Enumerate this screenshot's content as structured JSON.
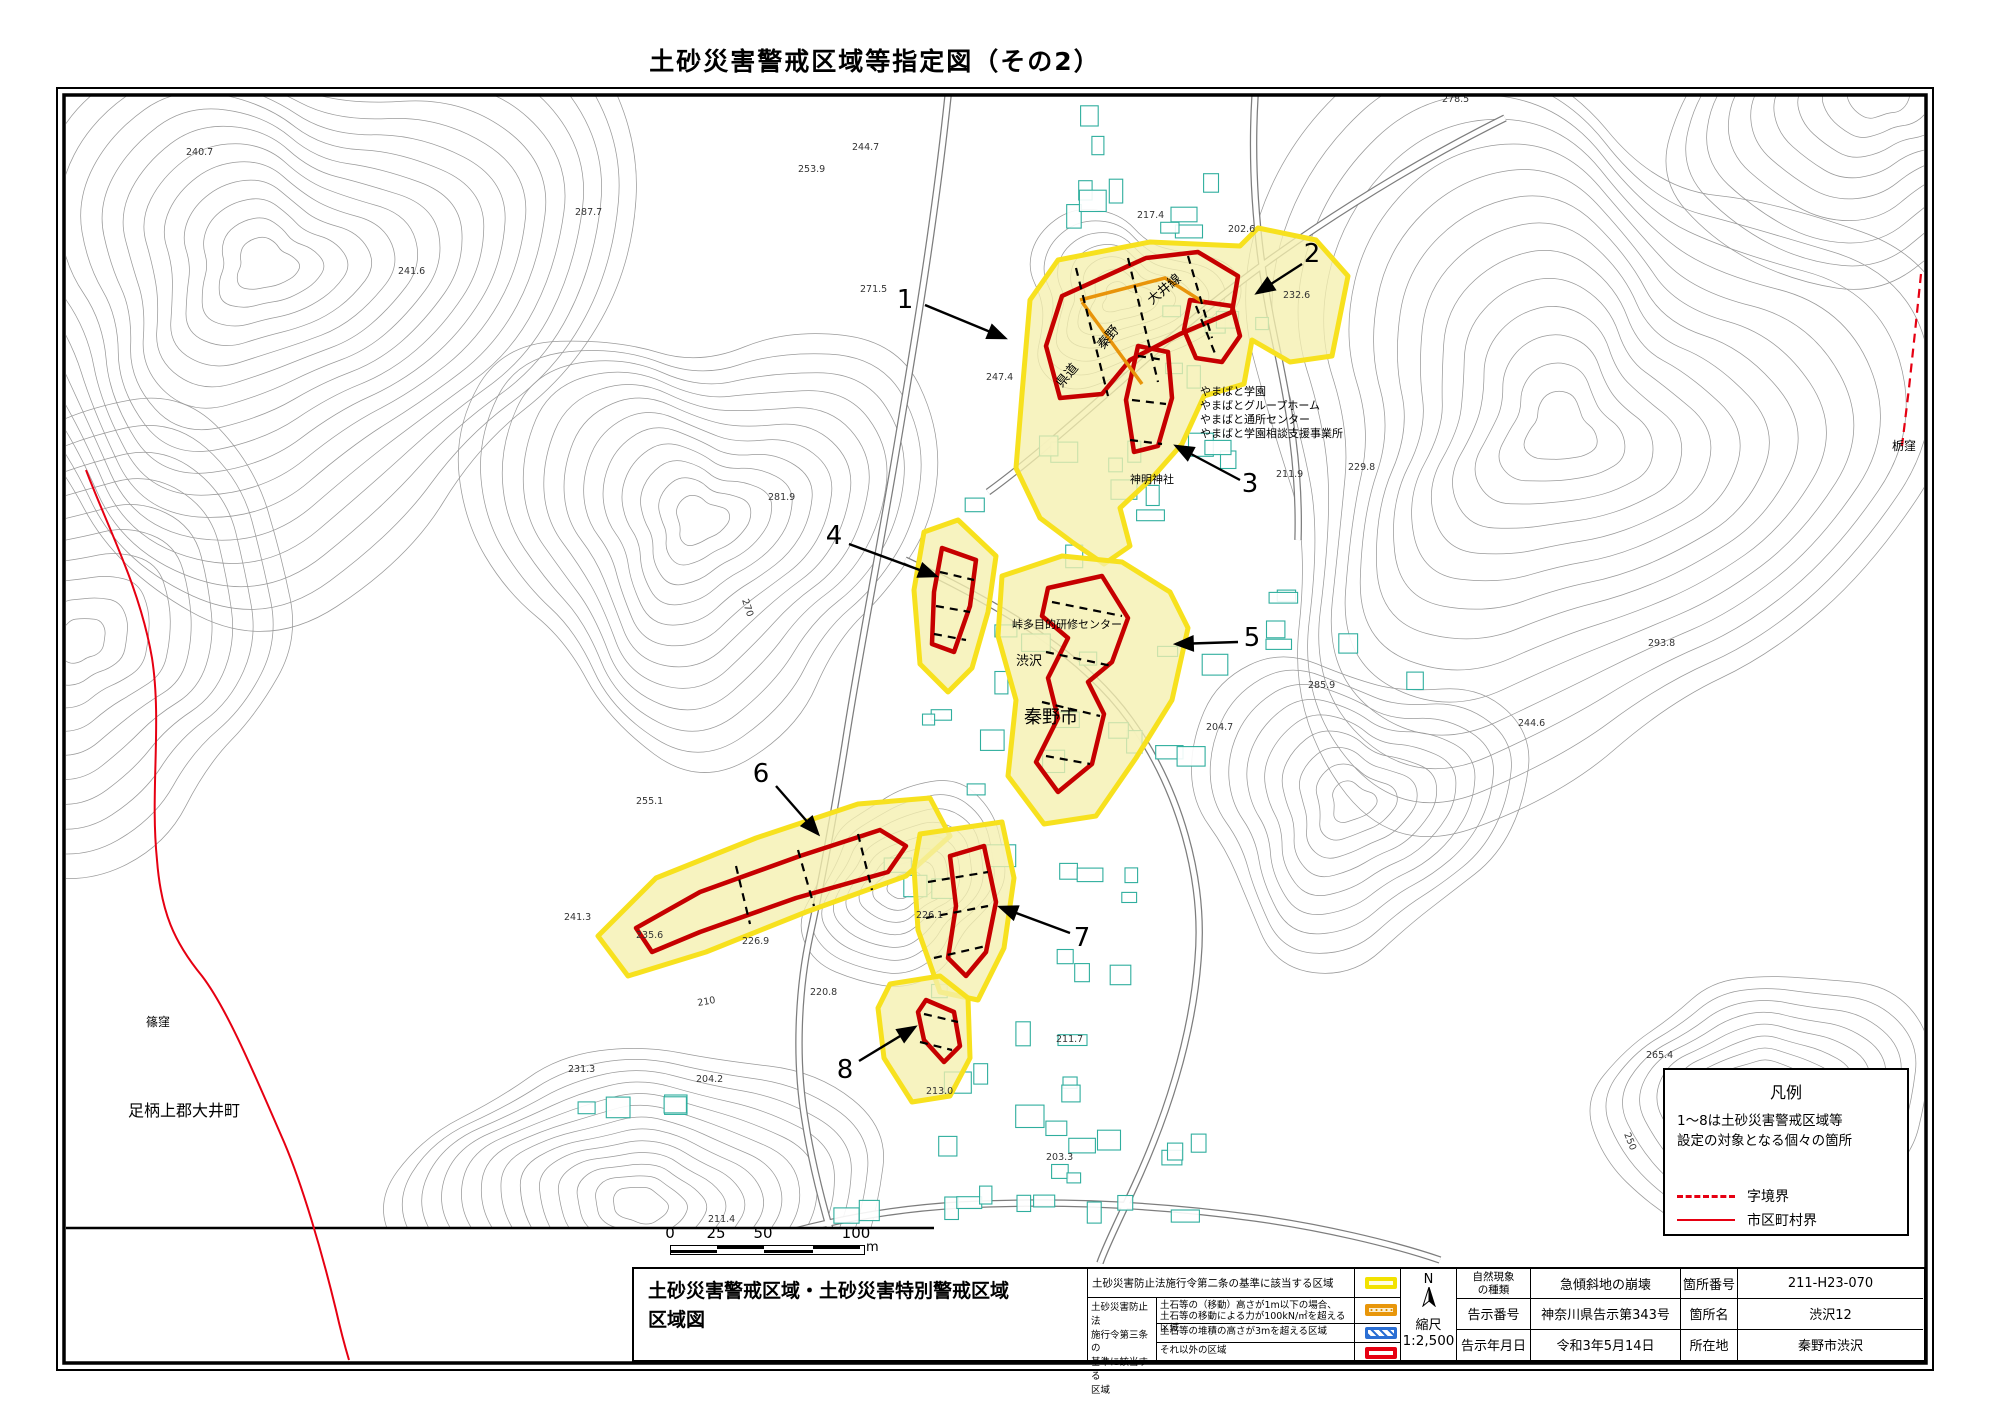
{
  "title": "土砂災害警戒区域等指定図（その2）",
  "legend_box": {
    "title": "凡例",
    "note_line1": "1〜8は土砂災害警戒区域等",
    "note_line2": "設定の対象となる個々の箇所",
    "items": [
      {
        "label": "字境界",
        "style": "dashed-red-line"
      },
      {
        "label": "市区町村界",
        "style": "solid-red-line"
      }
    ]
  },
  "scale_bar": {
    "ticks": [
      "0",
      "25",
      "50",
      "100"
    ],
    "unit": "m"
  },
  "bottom_table": {
    "map_title_line1": "土砂災害警戒区域・土砂災害特別警戒区域",
    "map_title_line2": "区域図",
    "article2_label": "土砂災害防止法施行令第二条の基準に該当する区域",
    "article3_header_lines": [
      "土砂災害防止法",
      "施行令第三条の",
      "基準に該当する",
      "区域"
    ],
    "article3_rows": [
      {
        "label_line1": "土石等の（移動）高さが1m以下の場合、",
        "label_line2": "土石等の移動による力が100kN/㎡を超える区域",
        "swatch": "orange-dotted"
      },
      {
        "label_line1": "土石等の堆積の高さが3mを超える区域",
        "label_line2": "",
        "swatch": "blue-hatched"
      },
      {
        "label_line1": "それ以外の区域",
        "label_line2": "",
        "swatch": "red-outline"
      }
    ],
    "north_label": "N",
    "scale_label": "縮尺",
    "scale_value": "1:2,500",
    "info_rows": [
      {
        "label1_lines": [
          "自然現象",
          "の種類"
        ],
        "label1": "自然現象の種類",
        "value1": "急傾斜地の崩壊",
        "label2": "箇所番号",
        "value2": "211-H23-070"
      },
      {
        "label1": "告示番号",
        "value1": "神奈川県告示第343号",
        "label2": "箇所名",
        "value2": "渋沢12"
      },
      {
        "label1": "告示年月日",
        "value1": "令和3年5月14日",
        "label2": "所在地",
        "value2": "秦野市渋沢"
      }
    ]
  },
  "map": {
    "place_labels": [
      {
        "text": "県道",
        "x": 1062,
        "y": 388,
        "size": 13,
        "rot": -50
      },
      {
        "text": "秦野",
        "x": 1103,
        "y": 350,
        "size": 13,
        "rot": -50
      },
      {
        "text": "大井線",
        "x": 1152,
        "y": 305,
        "size": 13,
        "rot": -40
      },
      {
        "text": "やまばと学園",
        "x": 1200,
        "y": 395,
        "size": 11
      },
      {
        "text": "やまばとグループホーム",
        "x": 1200,
        "y": 409,
        "size": 11
      },
      {
        "text": "やまばと通所センター",
        "x": 1200,
        "y": 423,
        "size": 11
      },
      {
        "text": "やまばと学園相談支援事業所",
        "x": 1200,
        "y": 437,
        "size": 11
      },
      {
        "text": "神明神社",
        "x": 1130,
        "y": 483,
        "size": 11
      },
      {
        "text": "峠多目的研修センター",
        "x": 1012,
        "y": 628,
        "size": 11
      },
      {
        "text": "渋沢",
        "x": 1016,
        "y": 665,
        "size": 13
      },
      {
        "text": "秦野市",
        "x": 1024,
        "y": 723,
        "size": 18
      },
      {
        "text": "篠窪",
        "x": 146,
        "y": 1026,
        "size": 12
      },
      {
        "text": "足柄上郡大井町",
        "x": 128,
        "y": 1116,
        "size": 16
      },
      {
        "text": "栃窪",
        "x": 1892,
        "y": 450,
        "size": 12
      }
    ],
    "elevation_labels": [
      {
        "text": "278.5",
        "x": 1442,
        "y": 102
      },
      {
        "text": "244.7",
        "x": 852,
        "y": 150
      },
      {
        "text": "253.9",
        "x": 798,
        "y": 172
      },
      {
        "text": "240.7",
        "x": 186,
        "y": 155
      },
      {
        "text": "287.7",
        "x": 575,
        "y": 215
      },
      {
        "text": "271.5",
        "x": 860,
        "y": 292
      },
      {
        "text": "241.6",
        "x": 398,
        "y": 274
      },
      {
        "text": "217.4",
        "x": 1137,
        "y": 218
      },
      {
        "text": "202.6",
        "x": 1228,
        "y": 232
      },
      {
        "text": "232.6",
        "x": 1283,
        "y": 298
      },
      {
        "text": "247.4",
        "x": 986,
        "y": 380
      },
      {
        "text": "211.9",
        "x": 1276,
        "y": 477
      },
      {
        "text": "281.9",
        "x": 768,
        "y": 500
      },
      {
        "text": "270",
        "x": 742,
        "y": 600,
        "rot": 72
      },
      {
        "text": "229.8",
        "x": 1348,
        "y": 470
      },
      {
        "text": "285.9",
        "x": 1308,
        "y": 688
      },
      {
        "text": "244.6",
        "x": 1518,
        "y": 726
      },
      {
        "text": "293.8",
        "x": 1648,
        "y": 646
      },
      {
        "text": "265.4",
        "x": 1646,
        "y": 1058
      },
      {
        "text": "250",
        "x": 1624,
        "y": 1134,
        "rot": 68
      },
      {
        "text": "255.1",
        "x": 636,
        "y": 804
      },
      {
        "text": "241.3",
        "x": 564,
        "y": 920
      },
      {
        "text": "235.6",
        "x": 636,
        "y": 938
      },
      {
        "text": "226.9",
        "x": 742,
        "y": 944
      },
      {
        "text": "220.8",
        "x": 810,
        "y": 995
      },
      {
        "text": "226.1",
        "x": 916,
        "y": 918
      },
      {
        "text": "210",
        "x": 698,
        "y": 1006,
        "rot": -10
      },
      {
        "text": "204.2",
        "x": 696,
        "y": 1082
      },
      {
        "text": "231.3",
        "x": 568,
        "y": 1072
      },
      {
        "text": "211.4",
        "x": 708,
        "y": 1222
      },
      {
        "text": "213.0",
        "x": 926,
        "y": 1094
      },
      {
        "text": "204.7",
        "x": 1206,
        "y": 730
      },
      {
        "text": "203.3",
        "x": 1046,
        "y": 1160
      },
      {
        "text": "211.7",
        "x": 1056,
        "y": 1042
      }
    ],
    "zone_markers": [
      {
        "num": "1",
        "tx": 905,
        "ty": 308,
        "x1": 925,
        "y1": 305,
        "x2": 1005,
        "y2": 338
      },
      {
        "num": "2",
        "tx": 1312,
        "ty": 262,
        "x1": 1302,
        "y1": 264,
        "x2": 1257,
        "y2": 293
      },
      {
        "num": "3",
        "tx": 1250,
        "ty": 492,
        "x1": 1240,
        "y1": 480,
        "x2": 1176,
        "y2": 446
      },
      {
        "num": "4",
        "tx": 834,
        "ty": 544,
        "x1": 849,
        "y1": 544,
        "x2": 936,
        "y2": 576
      },
      {
        "num": "5",
        "tx": 1252,
        "ty": 646,
        "x1": 1238,
        "y1": 642,
        "x2": 1176,
        "y2": 644
      },
      {
        "num": "6",
        "tx": 761,
        "ty": 782,
        "x1": 776,
        "y1": 786,
        "x2": 818,
        "y2": 834
      },
      {
        "num": "7",
        "tx": 1082,
        "ty": 946,
        "x1": 1070,
        "y1": 933,
        "x2": 1000,
        "y2": 907
      },
      {
        "num": "8",
        "tx": 845,
        "ty": 1078,
        "x1": 859,
        "y1": 1061,
        "x2": 915,
        "y2": 1027
      }
    ]
  },
  "colors": {
    "warning_yellow_border": "#f7e11e",
    "warning_yellow_fill": "#f5efae",
    "special_red": "#c60000",
    "orange_line": "#e8940a",
    "blue_hatch": "#2b6fd4",
    "boundary_red": "#e60012",
    "building_teal": "#2fae9e"
  }
}
